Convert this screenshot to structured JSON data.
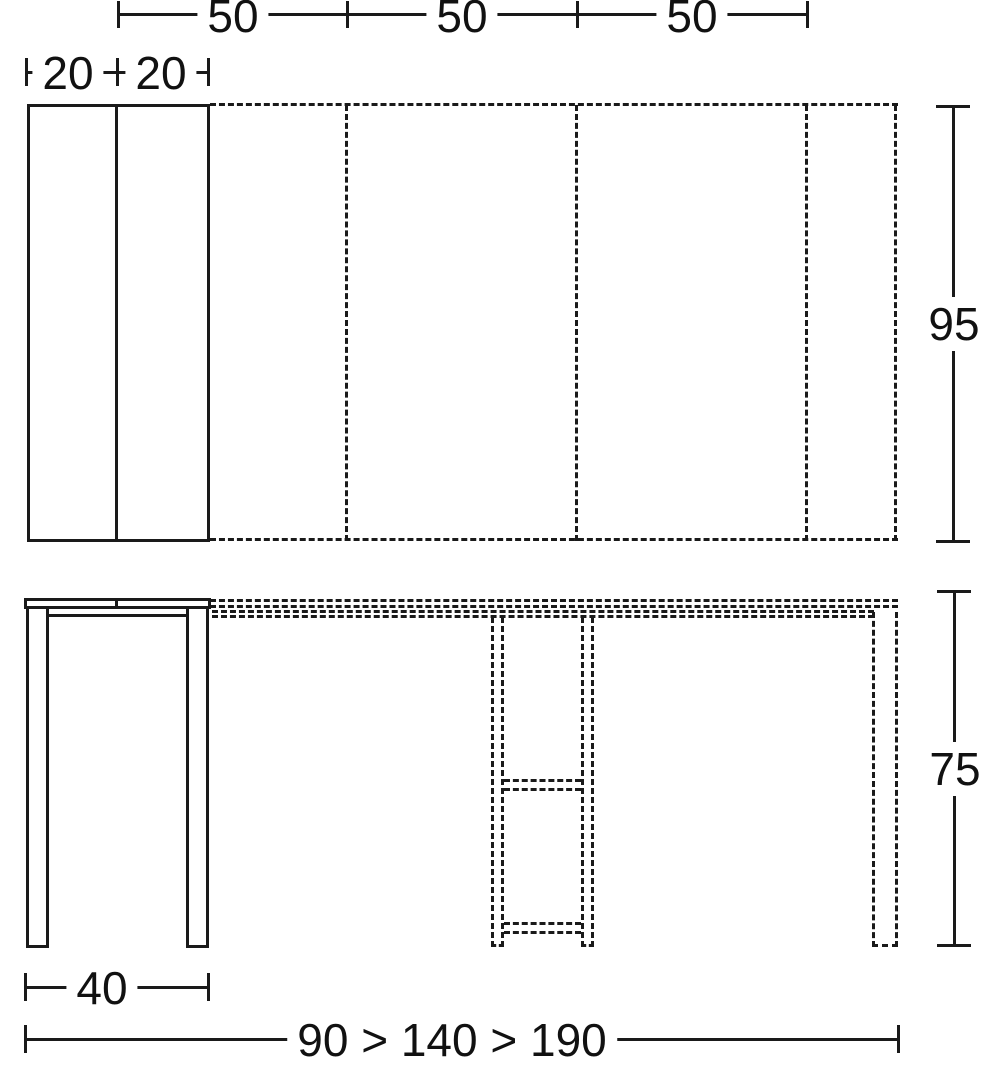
{
  "diagram": {
    "kind": "furniture-dimension-drawing",
    "line_color": "#1a1a1a",
    "background_color": "#ffffff",
    "top_view": {
      "extension_segment_labels": [
        "50",
        "50",
        "50"
      ],
      "closed_leaf_labels": [
        "20",
        "20"
      ],
      "depth_label": "95"
    },
    "side_view": {
      "height_label": "75",
      "base_width_label": "40",
      "length_progression_label": "90 > 140 > 190"
    }
  }
}
